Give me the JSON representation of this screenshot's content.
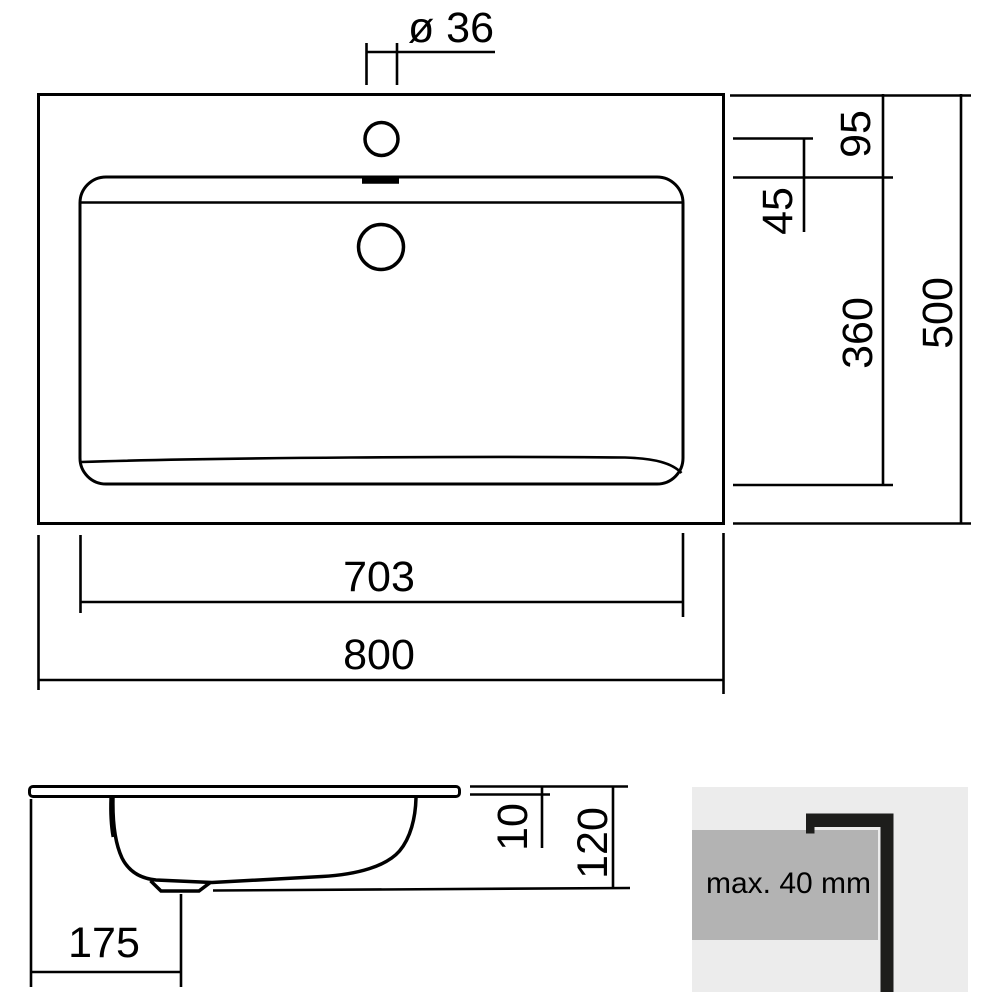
{
  "top_view": {
    "faucet_hole_diameter": "ø 36",
    "front_edge_to_basin": "95",
    "faucet_to_basin_edge": "45",
    "basin_depth": "360",
    "overall_depth": "500",
    "basin_width": "703",
    "overall_width": "800"
  },
  "side_view": {
    "drain_offset": "175",
    "top_thickness": "10",
    "overall_height": "120"
  },
  "detail": {
    "note": "max. 40 mm"
  },
  "colors": {
    "line": "#000000",
    "detail_box_background": "#ececec",
    "countertop_fill": "#b3b3b3",
    "profile_fill": "#1d1d1b",
    "note_text": "#3a3a3a"
  }
}
